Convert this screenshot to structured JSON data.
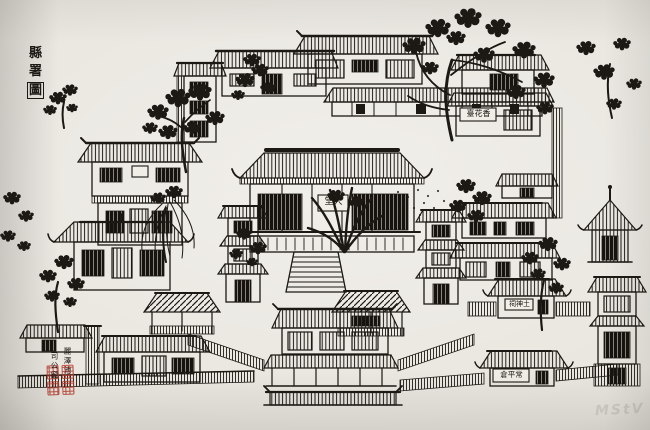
{
  "labels": {
    "title": "縣署圖",
    "title_chars": [
      "縣",
      "署",
      "圖"
    ],
    "main_hall": {
      "name": "大堂",
      "display": "堂大"
    },
    "incense_hall": {
      "name": "香花臺",
      "display": "臺花香"
    },
    "earth_god_shrine": {
      "name": "土神祠",
      "display": "祠神土"
    },
    "granary": {
      "name": "常平倉",
      "display": "倉平常"
    },
    "pond_col": "麗澤池",
    "office_col": "司公廨"
  },
  "seal": {
    "color": "#b5392c",
    "legible": false
  },
  "watermark": {
    "text": "MStV"
  },
  "colors": {
    "paper": "#e9e6df",
    "ink": "#1c1813",
    "seal_red": "#b5392c"
  }
}
